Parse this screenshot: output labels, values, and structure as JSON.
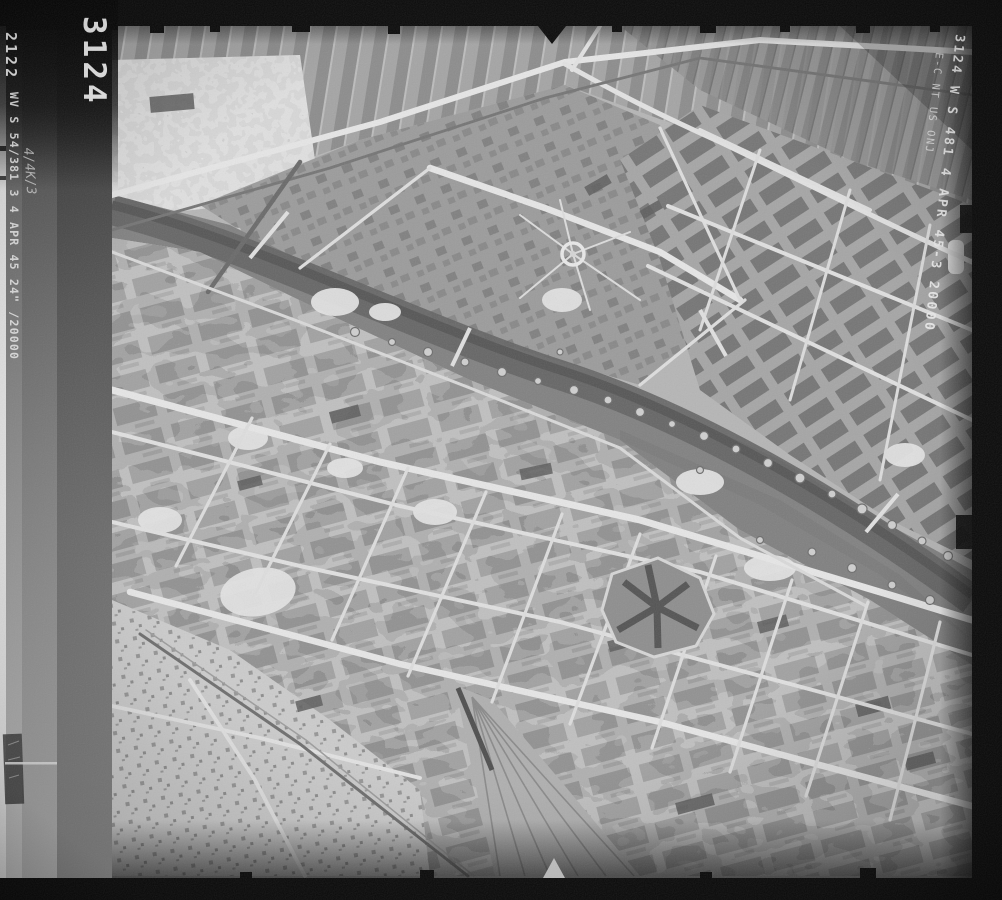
{
  "film_markings": {
    "frame_number_large": "3124",
    "frame_number_small": "2122",
    "left_annotation": "WV S 54/381 3 4 APR 45 24\" /20000",
    "left_handwritten": "4/4K/3",
    "right_annotation_line1": "3124 W S 481 4 APR 45-3 20000",
    "right_annotation_line2": "E-C NT US ONJ"
  }
}
